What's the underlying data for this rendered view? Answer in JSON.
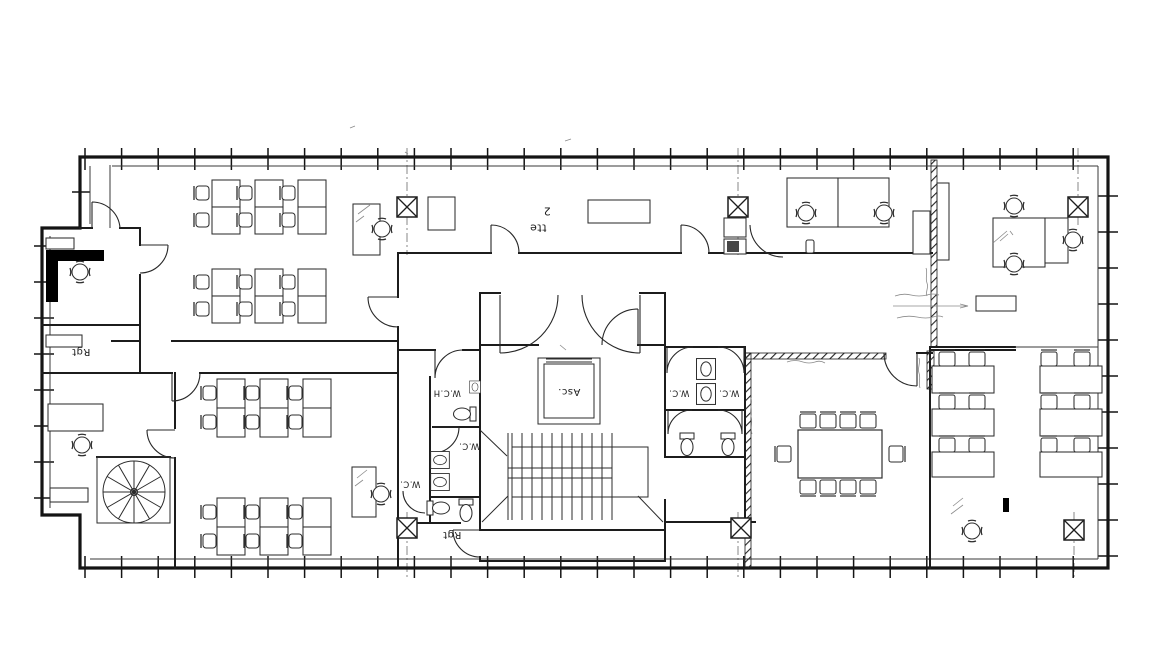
{
  "colors": {
    "paper": "#ffffff",
    "ink": "#1a1a1a",
    "ink_light": "#555555",
    "annotation_gray": "#8a8a8a"
  },
  "labels": {
    "storage_left": "Rgt",
    "room_tag_line1": "tte",
    "room_tag_line2": "2",
    "elevator": "Asc.",
    "wc_handicap": "W.C.H",
    "wc_center": "W.C.",
    "wc_lower_left": "W.C.",
    "wc_right_stall_a": "W.C.",
    "wc_right_stall_b": "W.C.",
    "storage_bottom": "Rgt"
  }
}
